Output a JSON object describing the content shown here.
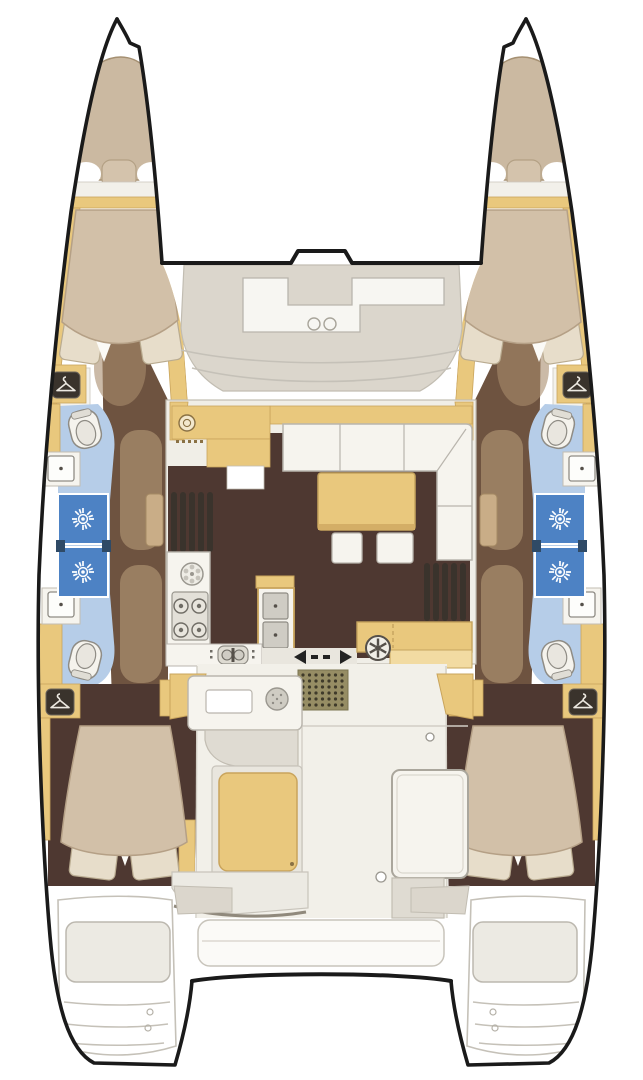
{
  "diagram": {
    "type": "boat-floor-plan",
    "vessel": "sailing-catamaran",
    "view": "top-down accommodation and deck plan"
  },
  "palette": {
    "outline_black": "#1a1a1a",
    "hull_white": "#ffffff",
    "deck_gray": "#dbd6cc",
    "deck_recess_white": "#f7f6f2",
    "counter_white": "#f6f4ee",
    "furniture_yellow": "#e9c87d",
    "furniture_yellow_light": "#f2dba2",
    "floor_dark_brown": "#4e3831",
    "corridor_brown": "#6e5340",
    "corridor_shade": "#a88c6c",
    "door_tan": "#c9ad87",
    "bed_beige": "#d2c0a8",
    "bow_cushion_beige": "#cbb9a1",
    "pillow_cream": "#e7ddca",
    "bathroom_blue": "#b6cde8",
    "shower_blue": "#4d82c4",
    "shower_divider_navy": "#2f4a66",
    "doormat_olive": "#968d64",
    "detail_gray": "#b9b5ad",
    "bench_gray": "#e9e6de",
    "panel_gray": "#dfdbd2",
    "icon_dark": "#3a332c"
  },
  "features": {
    "hulls": [
      "port",
      "starboard"
    ],
    "per_hull": [
      "bow-locker-cushion",
      "forward-cabin-double-berth",
      "wardrobe-hanger-locker-forward",
      "forward-bathroom-toilet-basin",
      "two-shower-stalls",
      "aft-bathroom-toilet-basin",
      "corridor",
      "wardrobe-hanger-locker-aft",
      "aft-cabin-double-berth",
      "transom-steps"
    ],
    "bridgedeck": [
      "foredeck-recessed-seating",
      "two-deck-hatches",
      "forward-crossbeam",
      "salon-galley-counter",
      "round-galley-sink",
      "four-burner-stove",
      "double-sink-unit",
      "l-shaped-sofa",
      "dining-table",
      "two-ottomans",
      "steps-to-port-hull",
      "steps-to-starboard-hull",
      "chart-desk-with-stool",
      "sliding-door",
      "doormat",
      "cockpit-counter",
      "cockpit-bench-yellow-cushion",
      "cockpit-table",
      "aft-bench",
      "aft-crossbeam",
      "swim-platforms"
    ]
  },
  "counts": {
    "double_berths": 4,
    "shower_stalls": 4,
    "toilets": 4,
    "basins": 4,
    "stove_burners": 4,
    "deck_hatches": 2,
    "hanger_lockers": 4
  },
  "icons": [
    "hanger-icon",
    "shower-spray-icon",
    "toilet-icon",
    "basin-icon",
    "burner-icon",
    "round-sink-icon",
    "stool-wheel-icon",
    "sliding-door-arrow-icons",
    "deck-hatch-icon",
    "doormat-grid-icon"
  ]
}
